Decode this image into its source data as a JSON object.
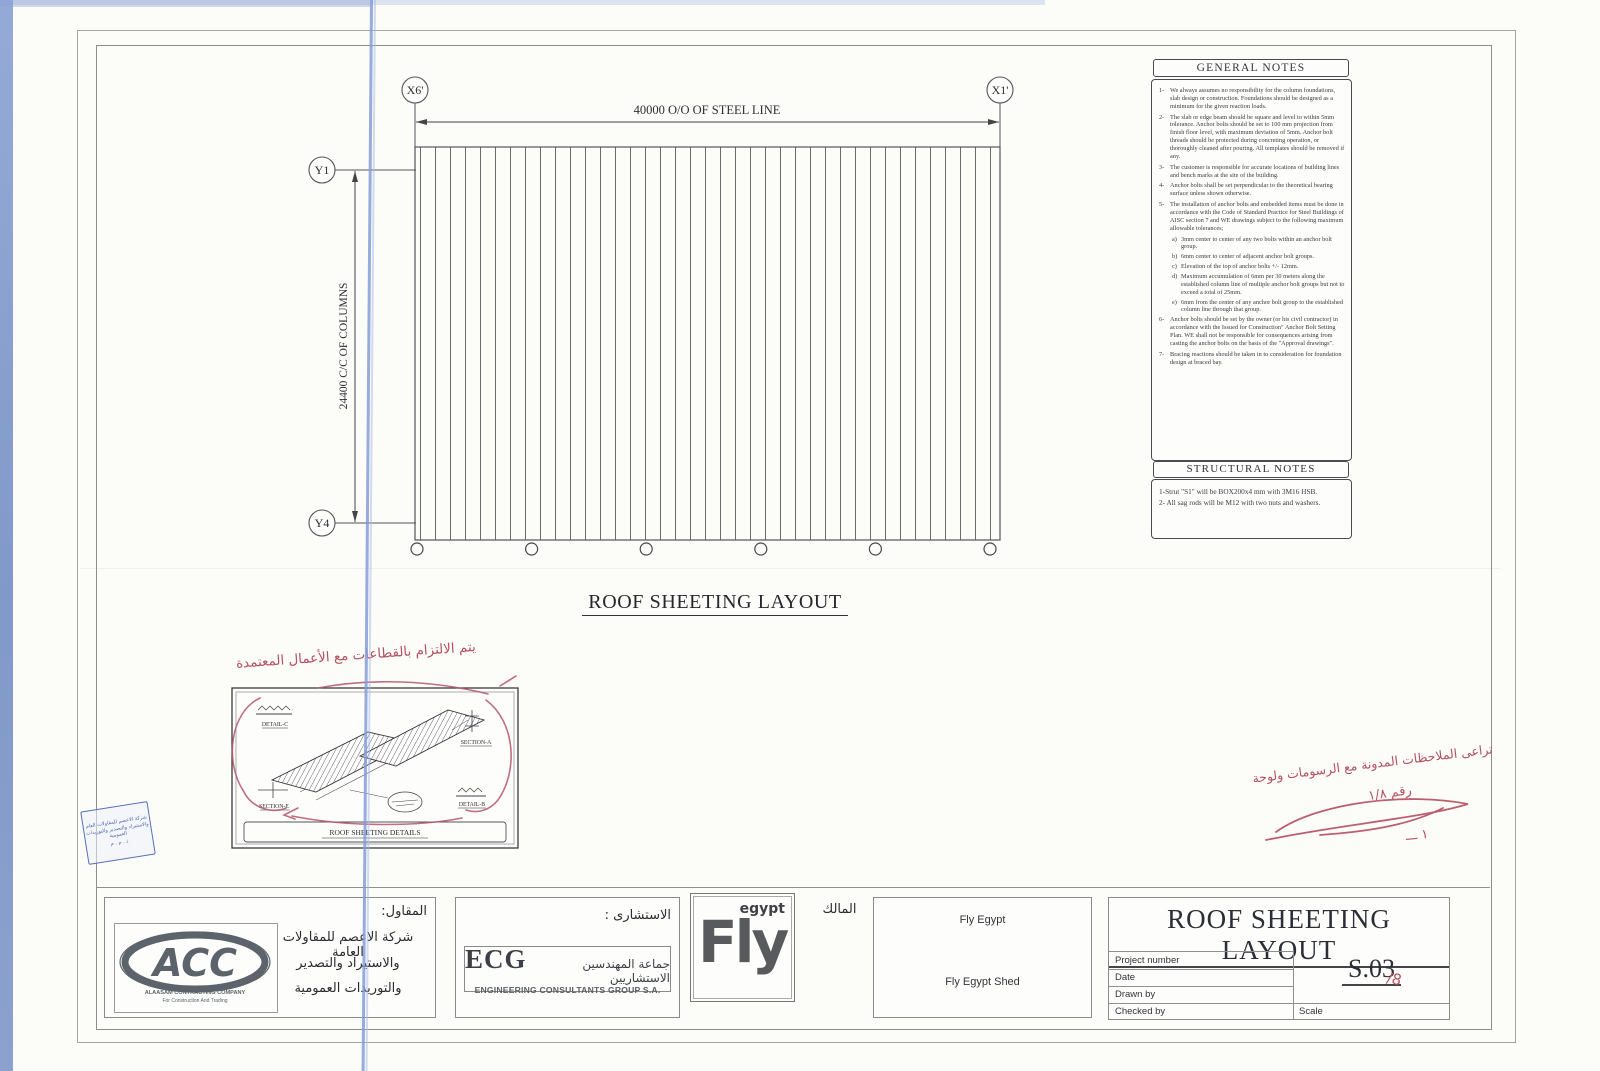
{
  "drawing": {
    "title": "ROOF SHEETING LAYOUT",
    "grid": {
      "x_left": "X6'",
      "x_right": "X1'",
      "y_top": "Y1",
      "y_bottom": "Y4"
    },
    "dim_horizontal": "40000 O/O OF STEEL LINE",
    "dim_vertical": "24400 C/C OF COLUMNS"
  },
  "general_notes": {
    "title": "GENERAL NOTES",
    "items": [
      {
        "num": "1-",
        "text": "We always assumes no responsibility for the column foundations, slab design or construction. Foundations should be designed as a minimum for the given reaction loads."
      },
      {
        "num": "2-",
        "text": "The slab or edge beam should be square and level to within 5mm tolerance. Anchor bolts should be set to 100 mm projection from finish floor level, with maximum deviation of 5mm. Anchor bolt threads should be protected during concreting operation, or thoroughly cleaned after pouring. All templates should be removed if any."
      },
      {
        "num": "3-",
        "text": "The customer is responsible for accurate locations of building lines and bench marks at the site of the building."
      },
      {
        "num": "4-",
        "text": "Anchor bolts shall be set perpendicular to the theoretical bearing surface unless shown otherwise."
      },
      {
        "num": "5-",
        "text": "The installation of anchor bolts and embedded items must be done in accordance with the Code of Standard Practice for Steel Buildings of AISC section 7 and WE drawings subject to the following maximum allowable tolerances;"
      },
      {
        "num": "6-",
        "text": "Anchor bolts should be set by the owner (or his civil contractor) in accordance with the Issued for Construction\" Anchor Bolt Setting Plan. WE shall not be responsible for consequences arising from casting the anchor bolts on the basis of the \"Approval drawings\"."
      },
      {
        "num": "7-",
        "text": "Bracing reactions should be taken in to consideration for foundation design at braced bay."
      }
    ],
    "note5_subs": [
      {
        "num": "a)",
        "text": "3mm center to center of any two bolts within an anchor bolt group."
      },
      {
        "num": "b)",
        "text": "6mm center to center of adjacent anchor bolt groups."
      },
      {
        "num": "c)",
        "text": "Elevation of the top of anchor bolts +/- 12mm."
      },
      {
        "num": "d)",
        "text": "Maximum accumulation of 6mm per 30 meters along the established column line of multiple anchor bolt groups but not to exceed a total of 25mm."
      },
      {
        "num": "e)",
        "text": "6mm from the center of any anchor bolt group to the established column line through that group."
      }
    ]
  },
  "structural_notes": {
    "title": "STRUCTURAL NOTES",
    "items": [
      "1-Strut \"S1\" will be BOX200x4 mm with 3M16 HSB.",
      "2- All sag rods will be M12 with two nuts and washers."
    ]
  },
  "detail_inset": {
    "title": "ROOF SHEETING DETAILS",
    "labels": {
      "detail_c": "DETAIL-C",
      "section_a": "SECTION-A",
      "section_e": "SECTION-E",
      "detail_b": "DETAIL-B"
    }
  },
  "annotations": {
    "left_note": "يتم الالتزام بالقطاعات مع الأعمال المعتمدة",
    "right_note_line1": "تراعى الملاحظات المدونة مع الرسومات ولوحة",
    "right_note_line2": "رقم ١/٨",
    "right_mark": "١ ـــ",
    "sheet_no_mark": "/8"
  },
  "stamp": {
    "line1": "شركة الاعصم للمقاولات العام",
    "line2": "والاستيراد والتصدير والتوريدات العمومية",
    "line3": "ذ . م . م"
  },
  "title_block": {
    "contractor_label": "المقاول:",
    "contractor_line1": "شركة الاعصم للمقاولات العامة",
    "contractor_line2": "والاستيراد والتصدير",
    "contractor_line3": "والتوريدات العمومية",
    "acc": {
      "text": "ACC",
      "sub1": "ALAASAM CONTRACTING COMPANY",
      "sub2": "For Construction And Trading"
    },
    "consultant_label": "الاستشارى :",
    "ecg": {
      "text": "ECG",
      "arabic": "جماعة المهندسين الاستشاريين",
      "sub": "ENGINEERING CONSULTANTS GROUP S.A."
    },
    "owner_label": "المالك",
    "fly": {
      "text": "Fly",
      "sub": "egypt"
    },
    "owner_name": "Fly Egypt",
    "project_name": "Fly Egypt Shed",
    "sheet_title": "ROOF SHEETING LAYOUT",
    "field1": "Project number",
    "field2": "Date",
    "field3": "Drawn by",
    "field4": "Checked by",
    "scale_label": "Scale",
    "sheet_number": "S.03"
  }
}
